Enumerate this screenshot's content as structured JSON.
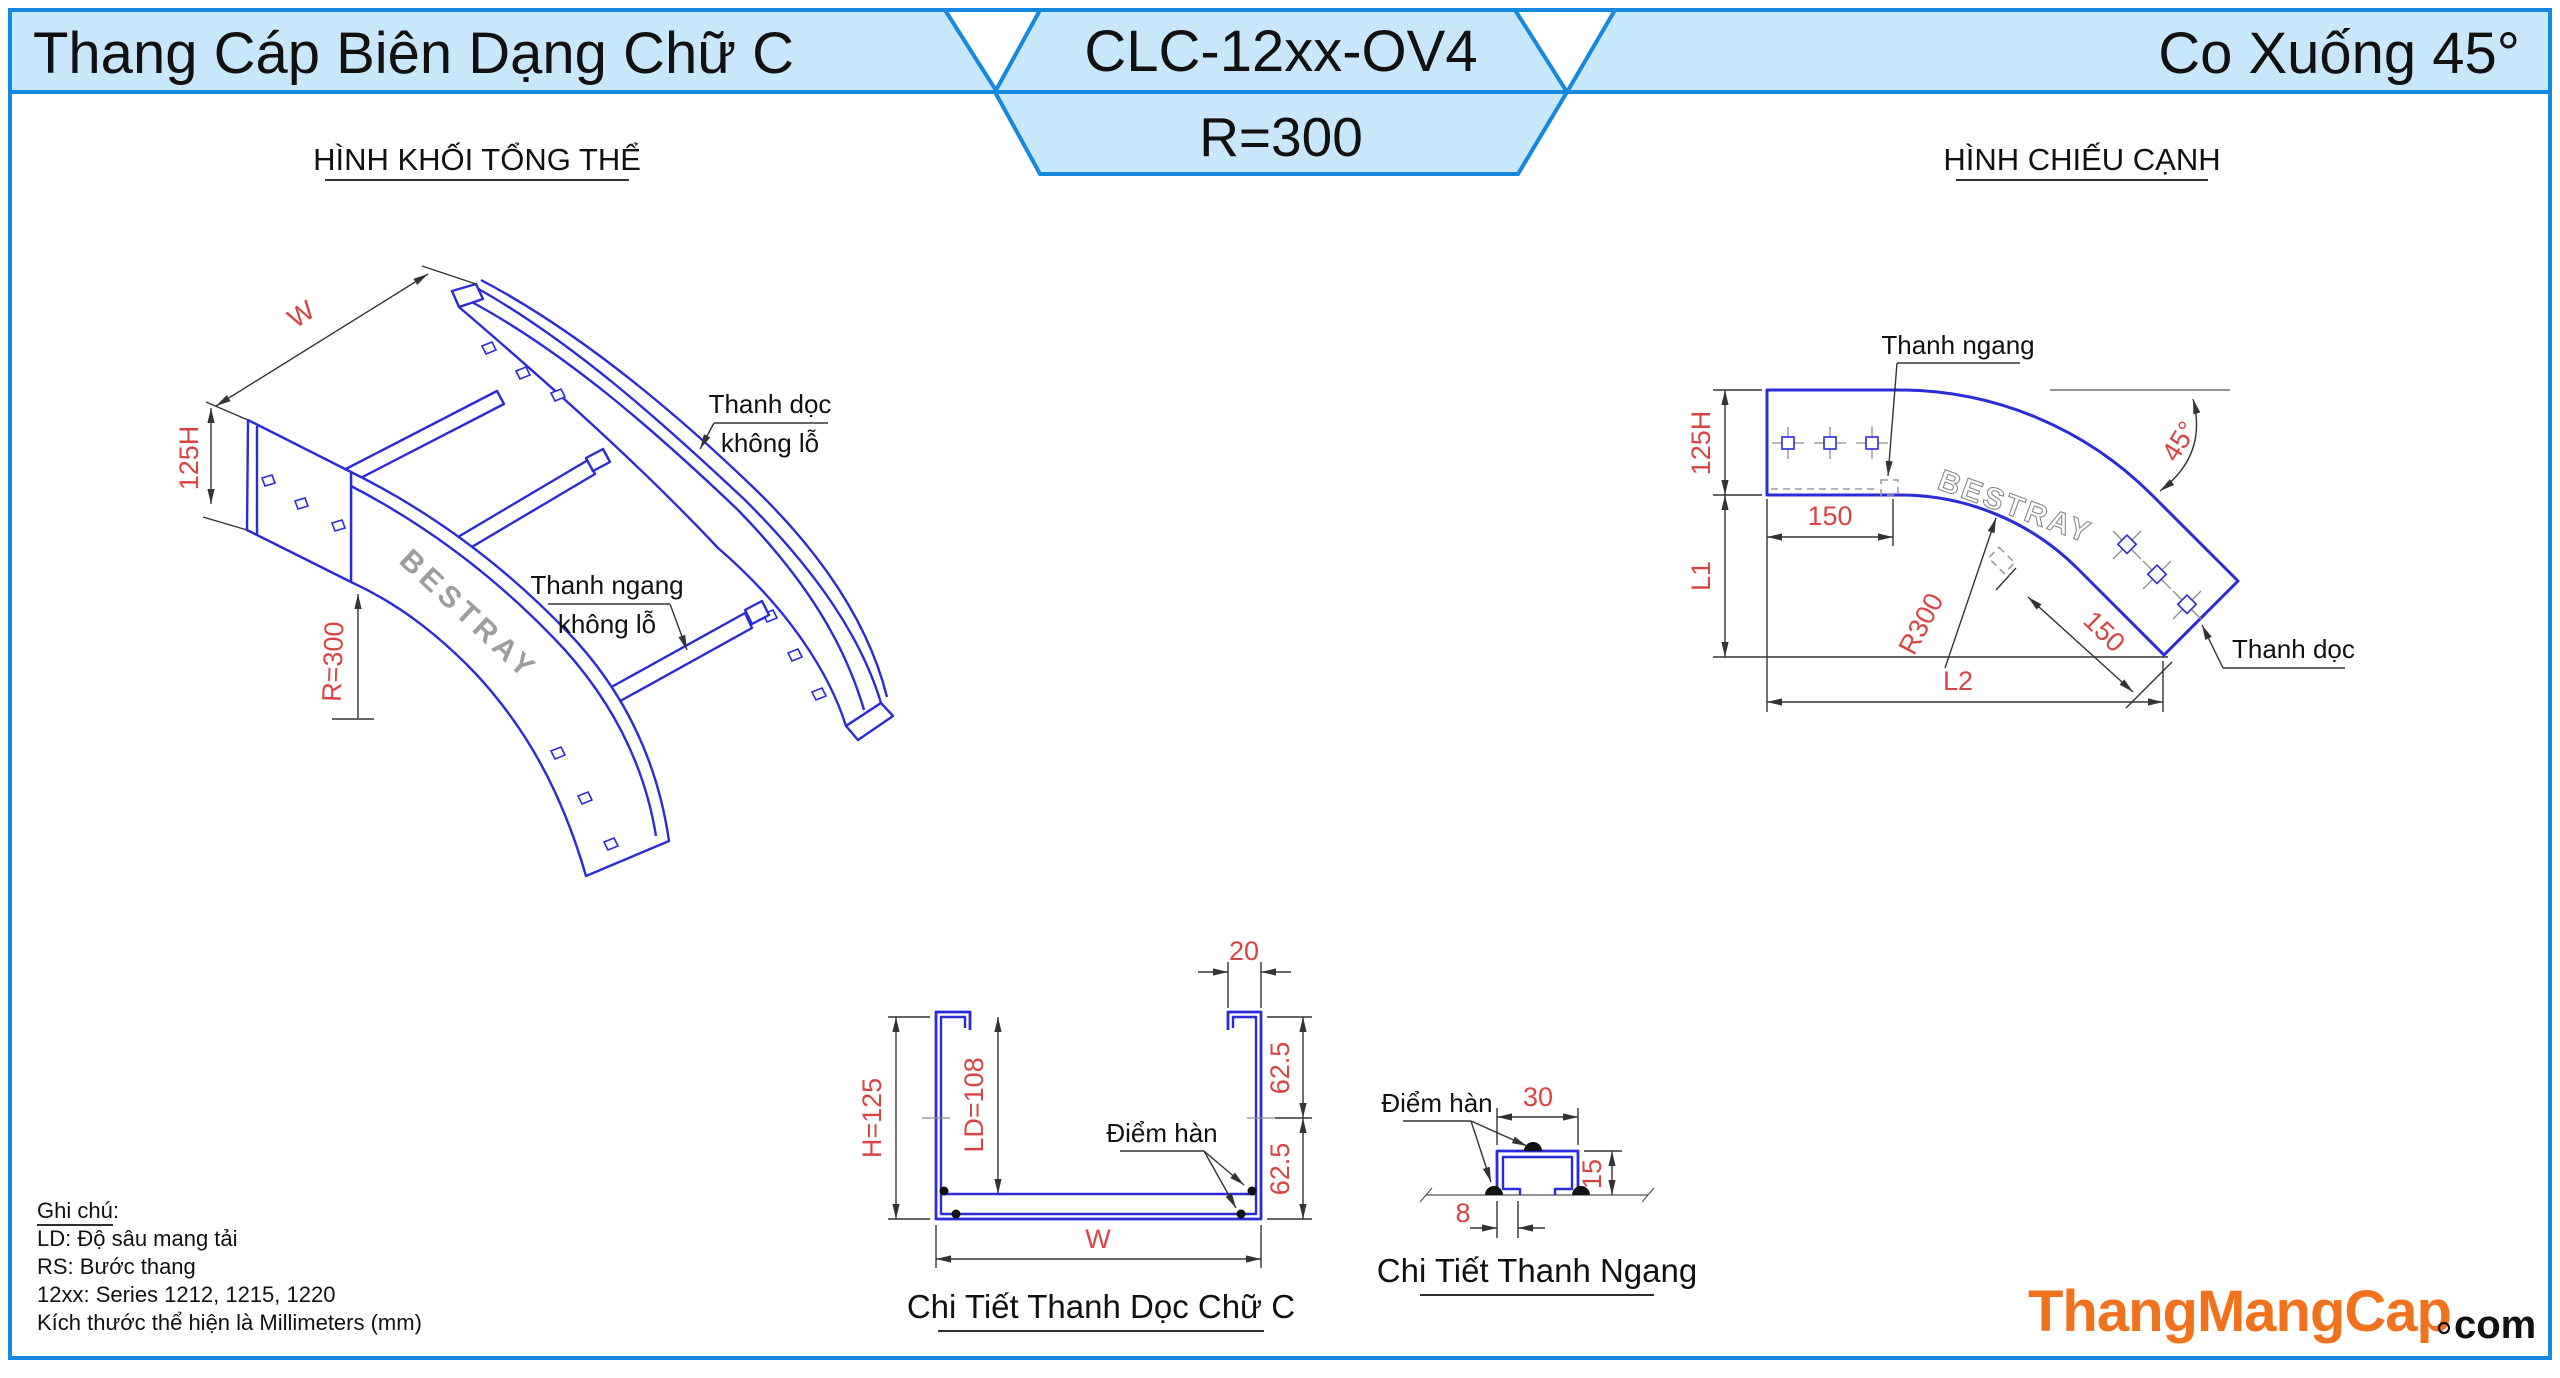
{
  "header": {
    "left_title": "Thang Cáp Biên Dạng Chữ C",
    "center_code": "CLC-12xx-OV4",
    "center_radius": "R=300",
    "right_title": "Co Xuống 45°"
  },
  "sections": {
    "overview_title": "HÌNH KHỐI TỔNG THỂ",
    "side_view_title": "HÌNH CHIẾU CẠNH"
  },
  "overview": {
    "dim_w": "W",
    "dim_h": "125H",
    "dim_r": "R=300",
    "label_thanh_doc_line1": "Thanh dọc",
    "label_thanh_doc_line2": "không lỗ",
    "label_thanh_ngang_line1": "Thanh ngang",
    "label_thanh_ngang_line2": "không lỗ",
    "watermark": "BESTRAY"
  },
  "side_view": {
    "dim_125h": "125H",
    "dim_l1": "L1",
    "dim_l2": "L2",
    "dim_150_top": "150",
    "dim_150_diag": "150",
    "dim_r300": "R300",
    "dim_45": "45°",
    "label_thanh_ngang": "Thanh ngang",
    "label_thanh_doc": "Thanh dọc",
    "watermark": "BESTRAY"
  },
  "c_detail": {
    "title": "Chi Tiết Thanh Dọc Chữ C",
    "dim_20": "20",
    "dim_h": "H=125",
    "dim_ld": "LD=108",
    "dim_62_top": "62.5",
    "dim_62_bottom": "62.5",
    "dim_w": "W",
    "weld_label": "Điểm hàn"
  },
  "rung_detail": {
    "title": "Chi Tiết Thanh Ngang",
    "dim_30": "30",
    "dim_15": "15",
    "dim_8": "8",
    "weld_label": "Điểm hàn"
  },
  "notes": {
    "title": "Ghi chú:",
    "line1": "LD: Độ sâu mang tải",
    "line2": "RS: Bước thang",
    "line3": "12xx: Series 1212, 1215, 1220",
    "line4": "Kích thước thể hiện là Millimeters (mm)"
  },
  "logo": {
    "brand": "ThangMangCap",
    "suffix": "com"
  },
  "colors": {
    "line_blue": "#2b2bd8",
    "dim_red": "#d94343",
    "header_fill": "#c9e7fb",
    "header_border": "#1688df",
    "brand_orange": "#f0721d"
  }
}
